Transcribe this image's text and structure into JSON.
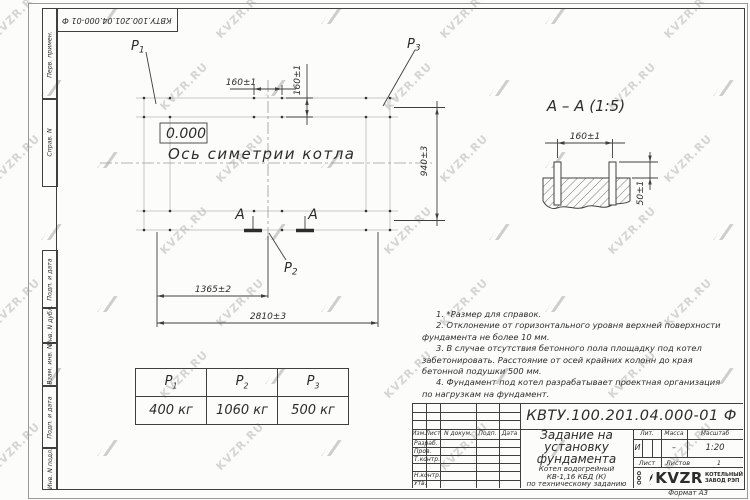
{
  "sheet": {
    "corner_stamp": "КВТУ.100.201.04.000-01 Ф",
    "format_note": "Формат А3"
  },
  "margin": {
    "labels": [
      "Перв. примен.",
      "Справ. N",
      "Подп. и дата",
      "Инв. N дубл.",
      "Взам. инв. N",
      "Подп. и дата",
      "Инв. N подл."
    ]
  },
  "plan": {
    "level_mark": "0.000",
    "axis_label": "Ось симетрии котла",
    "loads": [
      {
        "name": "P",
        "sub": "1"
      },
      {
        "name": "P",
        "sub": "2"
      },
      {
        "name": "P",
        "sub": "3"
      }
    ],
    "dims": {
      "bolt_spacing_x": "160±1",
      "bolt_spacing_y": "160±1",
      "width": "940±3",
      "center_offset": "1365±2",
      "total_length": "2810±3"
    },
    "section_mark": "А"
  },
  "section_view": {
    "title": "А – А (1:5)",
    "dims": {
      "bolt_spacing": "160±1",
      "protrusion": "50±1"
    }
  },
  "notes": [
    "1. *Размер для справок.",
    "2. Отклонение от горизонтального уровня верхней поверхности фундамента не более 10 мм.",
    "3. В случае отсутствия бетонного пола площадку под котел забетонировать. Расстояние от осей крайних колонн до края бетонной подушки 500 мм.",
    "4. Фундамент под котел разрабатывает проектная организация по нагрузкам на фундамент."
  ],
  "load_table": {
    "columns": [
      {
        "name": "P",
        "sub": "1",
        "value": "400 кг"
      },
      {
        "name": "P",
        "sub": "2",
        "value": "1060 кг"
      },
      {
        "name": "P",
        "sub": "3",
        "value": "500 кг"
      }
    ]
  },
  "title_block": {
    "designation": "КВТУ.100.201.04.000-01 Ф",
    "title_lines": [
      "Задание на",
      "установку",
      "фундамента"
    ],
    "product_lines": [
      "Котел водогрейный",
      "КВ-1,16 КБД (К)",
      "по техническому заданию"
    ],
    "header_columns": [
      "Изм.",
      "Лист",
      "N докум.",
      "Подп.",
      "Дата"
    ],
    "row_labels": [
      "Разраб.",
      "Пров.",
      "Т.контр.",
      "",
      "Н.контр.",
      "Утв."
    ],
    "lit": {
      "label": "Лит.",
      "value": "И"
    },
    "mass": {
      "label": "Масса",
      "value": "–"
    },
    "scale": {
      "label": "Масштаб",
      "value": "1:20"
    },
    "sheet": {
      "label": "Лист"
    },
    "sheets": {
      "label": "Листов",
      "value": "1"
    },
    "logo": {
      "ooo": "ООО",
      "name": "KVZR",
      "sub1": "КОТЕЛЬНЫЙ",
      "sub2": "ЗАВОД РЭП"
    }
  },
  "watermark": {
    "text": "KVZR.RU"
  }
}
